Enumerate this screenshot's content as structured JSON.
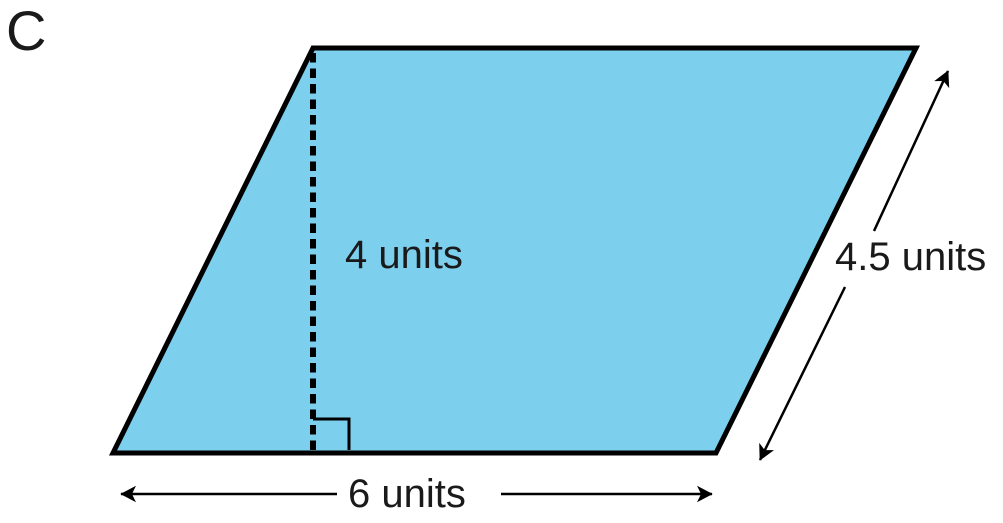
{
  "figure": {
    "title_label": "C",
    "shape": "parallelogram",
    "colors": {
      "fill": "#7DCFEE",
      "outline": "#000000"
    },
    "measurements": {
      "height": {
        "value": 4,
        "unit": "units",
        "label": "4 units"
      },
      "base": {
        "value": 6,
        "unit": "units",
        "label": "6 units"
      },
      "slant_side": {
        "value": 4.5,
        "unit": "units",
        "label": "4.5 units"
      }
    }
  }
}
